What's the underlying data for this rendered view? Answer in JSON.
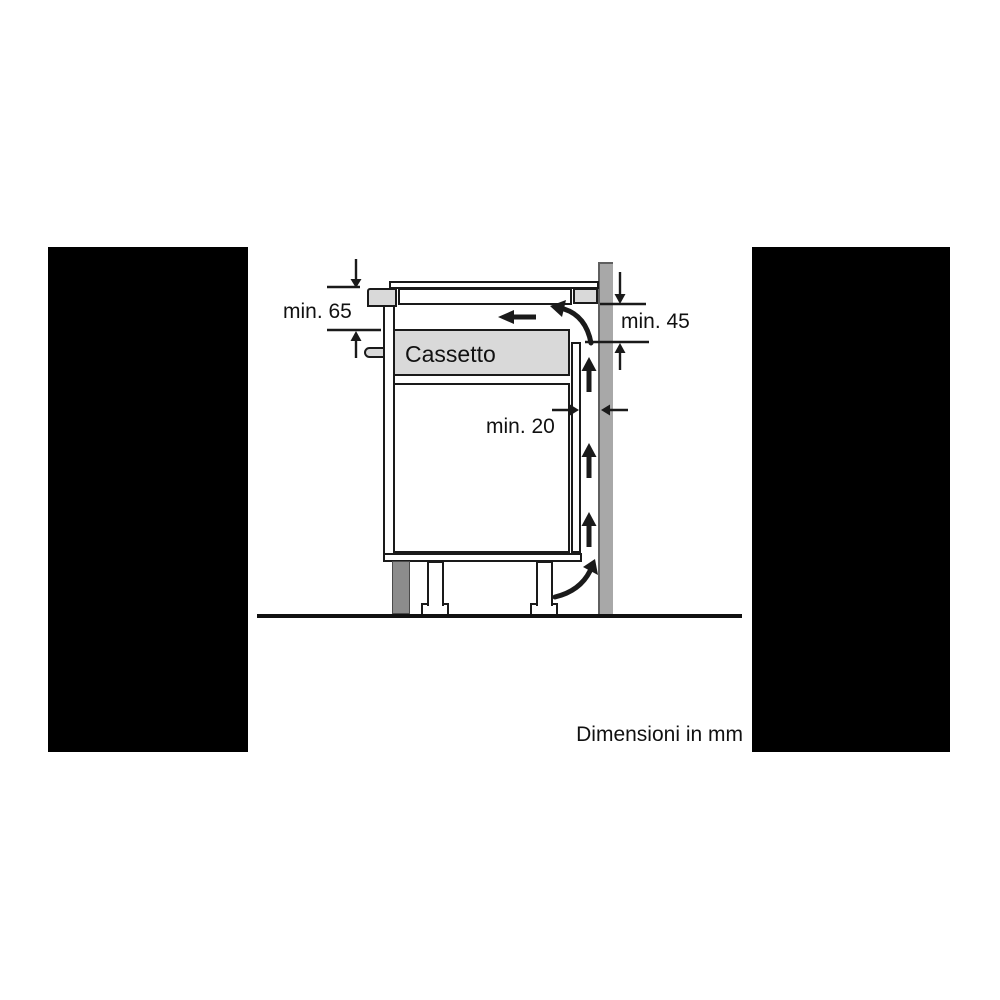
{
  "diagram": {
    "type": "hob-installation-side-view",
    "labels": {
      "dim_worktop_clearance": "min. 65",
      "dim_rear_vent_opening": "min. 45",
      "dim_wall_gap": "min. 20",
      "drawer": "Cassetto",
      "units_note": "Dimensioni in mm"
    },
    "icons": {
      "airflow_up": "arrow-up ↑",
      "exhaust_left": "arrow-left ←",
      "intake_curve_bottom": "curved-arrow-up-right",
      "exhaust_curve_top": "curved-arrow-left",
      "dim_arrow_down": "arrow-down ↓",
      "dim_arrow_up": "arrow-up ↑",
      "dim_arrow_right": "arrow-right →",
      "dim_arrow_left": "arrow-left ←"
    },
    "colors": {
      "background": "#ffffff",
      "mask_panels": "#000000",
      "line": "#1a1a1a",
      "light_gray_fill": "#d9d9d9",
      "wall_gray": "#a8a8a8",
      "plinth_gray": "#8c8c8c"
    }
  }
}
